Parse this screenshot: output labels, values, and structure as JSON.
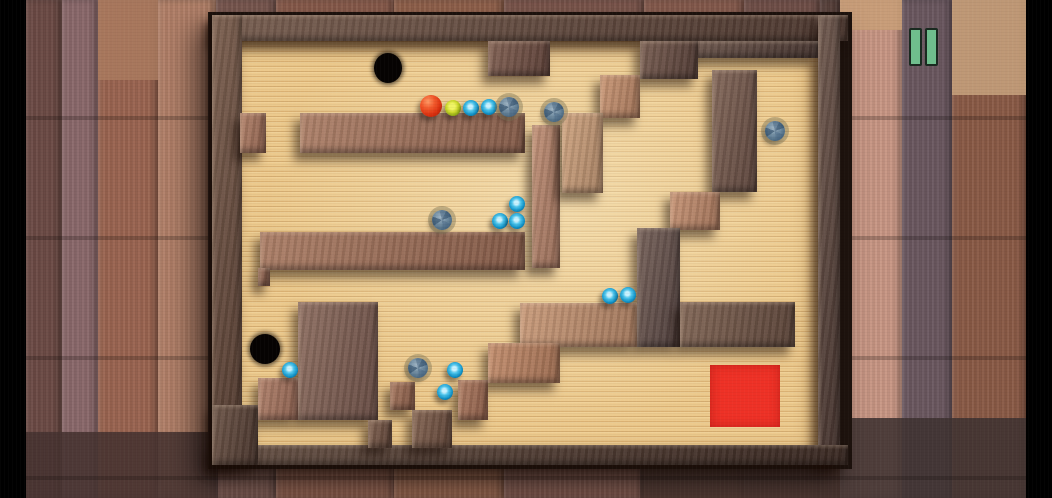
{
  "scene": {
    "width": 1052,
    "height": 498,
    "description": "top-down wooden labyrinth tilt-maze game on weathered wood plank table"
  },
  "letterbox": {
    "color": "#000000",
    "left_width": 26,
    "right_width": 26
  },
  "hud": {
    "pause_button": {
      "x": 905,
      "y": 24,
      "bar_width": 9,
      "bar_height": 34,
      "bar_gap": 7,
      "bar_color": "#6fbe8d",
      "bar_border": "#1a2a20",
      "bars": 2
    }
  },
  "background": {
    "base_color": "#7a5850",
    "planks": [
      {
        "x": 26,
        "w": 36,
        "c": "#6b4a44"
      },
      {
        "x": 62,
        "w": 36,
        "c": "#8a686a"
      },
      {
        "x": 98,
        "w": 60,
        "c": "#9a6450"
      },
      {
        "x": 158,
        "w": 58,
        "c": "#b28068"
      },
      {
        "x": 216,
        "w": 60,
        "c": "#7a5850"
      },
      {
        "x": 276,
        "w": 118,
        "c": "#8a5c4c"
      },
      {
        "x": 394,
        "w": 110,
        "c": "#92624c"
      },
      {
        "x": 504,
        "w": 140,
        "c": "#7c564c"
      },
      {
        "x": 644,
        "w": 100,
        "c": "#885c4e"
      },
      {
        "x": 744,
        "w": 76,
        "c": "#73514a"
      },
      {
        "x": 820,
        "w": 20,
        "c": "#5a423c"
      },
      {
        "x": 840,
        "w": 62,
        "c": "#c89684"
      },
      {
        "x": 902,
        "w": 50,
        "c": "#6a575f"
      },
      {
        "x": 952,
        "w": 74,
        "c": "#8a5a46"
      }
    ],
    "patches": [
      {
        "x": 840,
        "y": 0,
        "w": 62,
        "h": 30,
        "c": "#c89e78"
      },
      {
        "x": 952,
        "y": 0,
        "w": 74,
        "h": 95,
        "c": "#c6a07c"
      },
      {
        "x": 98,
        "y": 0,
        "w": 60,
        "h": 80,
        "c": "#aa7a5e"
      },
      {
        "x": 26,
        "y": 432,
        "w": 192,
        "h": 66,
        "c": "#453230"
      },
      {
        "x": 840,
        "y": 418,
        "w": 186,
        "h": 80,
        "c": "#3f3231"
      },
      {
        "x": 640,
        "y": 456,
        "w": 200,
        "h": 42,
        "c": "#4a3530"
      }
    ]
  },
  "maze": {
    "frame": {
      "x": 208,
      "y": 12,
      "w": 644,
      "h": 457,
      "color": "#1d120d"
    },
    "floor": {
      "color": "#ecc98c",
      "patches": [
        {
          "x": 240,
          "y": 41,
          "w": 578,
          "h": 404
        }
      ]
    },
    "walls": [
      {
        "x": 212,
        "y": 15,
        "w": 636,
        "h": 26,
        "c": "#5c4339"
      },
      {
        "x": 212,
        "y": 15,
        "w": 30,
        "h": 450,
        "c": "#624639"
      },
      {
        "x": 818,
        "y": 15,
        "w": 22,
        "h": 450,
        "c": "#533e38"
      },
      {
        "x": 212,
        "y": 445,
        "w": 636,
        "h": 20,
        "c": "#46322a"
      },
      {
        "x": 676,
        "y": 41,
        "w": 142,
        "h": 17,
        "c": "#55403a"
      },
      {
        "x": 488,
        "y": 41,
        "w": 62,
        "h": 35,
        "c": "#6b4a40"
      },
      {
        "x": 640,
        "y": 41,
        "w": 58,
        "h": 38,
        "c": "#5f453d"
      },
      {
        "x": 600,
        "y": 75,
        "w": 40,
        "h": 43,
        "c": "#c08968"
      },
      {
        "x": 240,
        "y": 113,
        "w": 26,
        "h": 40,
        "c": "#a4705a"
      },
      {
        "x": 300,
        "y": 113,
        "w": 225,
        "h": 40,
        "c": "#9e6e58"
      },
      {
        "x": 532,
        "y": 125,
        "w": 28,
        "h": 143,
        "c": "#b5826a"
      },
      {
        "x": 562,
        "y": 113,
        "w": 41,
        "h": 80,
        "c": "#c79a76"
      },
      {
        "x": 712,
        "y": 70,
        "w": 45,
        "h": 122,
        "c": "#6d5147"
      },
      {
        "x": 670,
        "y": 192,
        "w": 50,
        "h": 38,
        "c": "#bd8668"
      },
      {
        "x": 637,
        "y": 228,
        "w": 43,
        "h": 119,
        "c": "#5d4a47"
      },
      {
        "x": 680,
        "y": 302,
        "w": 115,
        "h": 45,
        "c": "#6a4f42"
      },
      {
        "x": 520,
        "y": 303,
        "w": 117,
        "h": 44,
        "c": "#c08e6e"
      },
      {
        "x": 488,
        "y": 343,
        "w": 72,
        "h": 40,
        "c": "#b97f5f"
      },
      {
        "x": 260,
        "y": 232,
        "w": 265,
        "h": 38,
        "c": "#9c6b55"
      },
      {
        "x": 258,
        "y": 268,
        "w": 12,
        "h": 18,
        "c": "#8a5c4a"
      },
      {
        "x": 298,
        "y": 302,
        "w": 80,
        "h": 118,
        "c": "#7a5a50"
      },
      {
        "x": 258,
        "y": 378,
        "w": 40,
        "h": 42,
        "c": "#a3705c"
      },
      {
        "x": 390,
        "y": 382,
        "w": 25,
        "h": 28,
        "c": "#96644e"
      },
      {
        "x": 458,
        "y": 380,
        "w": 30,
        "h": 40,
        "c": "#a06a52"
      },
      {
        "x": 412,
        "y": 410,
        "w": 40,
        "h": 38,
        "c": "#6f4f40"
      },
      {
        "x": 368,
        "y": 420,
        "w": 24,
        "h": 28,
        "c": "#6b4c3e"
      },
      {
        "x": 212,
        "y": 405,
        "w": 46,
        "h": 60,
        "c": "#533c33"
      }
    ],
    "holes": [
      {
        "x": 388,
        "y": 68,
        "rx": 14,
        "ry": 15
      },
      {
        "x": 265,
        "y": 349,
        "rx": 15,
        "ry": 15
      }
    ],
    "goal": {
      "x": 710,
      "y": 365,
      "w": 70,
      "h": 62,
      "color": "#ee3126"
    },
    "balls": [
      {
        "x": 431,
        "y": 106,
        "r": 11,
        "kind": "red"
      },
      {
        "x": 453,
        "y": 108,
        "r": 8,
        "kind": "yellow"
      },
      {
        "x": 471,
        "y": 108,
        "r": 8,
        "kind": "blue"
      },
      {
        "x": 489,
        "y": 107,
        "r": 8,
        "kind": "blue"
      },
      {
        "x": 509,
        "y": 107,
        "r": 10,
        "kind": "gray"
      },
      {
        "x": 554,
        "y": 112,
        "r": 10,
        "kind": "gray"
      },
      {
        "x": 775,
        "y": 131,
        "r": 10,
        "kind": "gray"
      },
      {
        "x": 442,
        "y": 220,
        "r": 10,
        "kind": "gray"
      },
      {
        "x": 517,
        "y": 204,
        "r": 8,
        "kind": "blue"
      },
      {
        "x": 500,
        "y": 221,
        "r": 8,
        "kind": "blue"
      },
      {
        "x": 517,
        "y": 221,
        "r": 8,
        "kind": "blue"
      },
      {
        "x": 610,
        "y": 296,
        "r": 8,
        "kind": "blue"
      },
      {
        "x": 628,
        "y": 295,
        "r": 8,
        "kind": "blue"
      },
      {
        "x": 290,
        "y": 370,
        "r": 8,
        "kind": "blue"
      },
      {
        "x": 418,
        "y": 368,
        "r": 10,
        "kind": "gray"
      },
      {
        "x": 455,
        "y": 370,
        "r": 8,
        "kind": "blue"
      },
      {
        "x": 445,
        "y": 392,
        "r": 8,
        "kind": "blue"
      }
    ],
    "counts": {
      "red": 1,
      "yellow": 1,
      "blue": 10,
      "gray": 5,
      "holes": 2
    }
  }
}
